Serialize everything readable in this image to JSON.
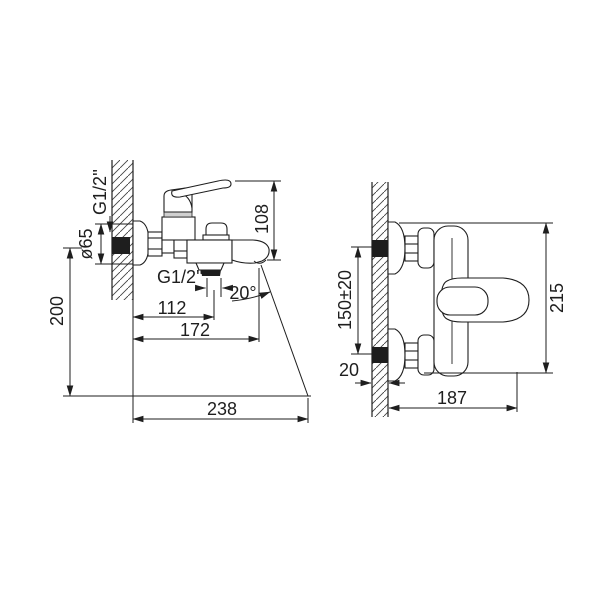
{
  "colors": {
    "background": "#ffffff",
    "line": "#1e1e1e"
  },
  "front_view": {
    "labels": {
      "inlet_thread": "G1/2''",
      "escutcheon_diameter": "ø65",
      "mounting_height": "200",
      "body_height": "108",
      "shower_outlet_thread": "G1/2''",
      "shower_outlet_offset": "112",
      "spout_reach": "172",
      "stream_angle": "20°",
      "stream_reach": "238"
    }
  },
  "side_view": {
    "labels": {
      "hole_spacing": "150±20",
      "wall_clearance": "20",
      "overall_depth": "187",
      "overall_height": "215"
    }
  }
}
